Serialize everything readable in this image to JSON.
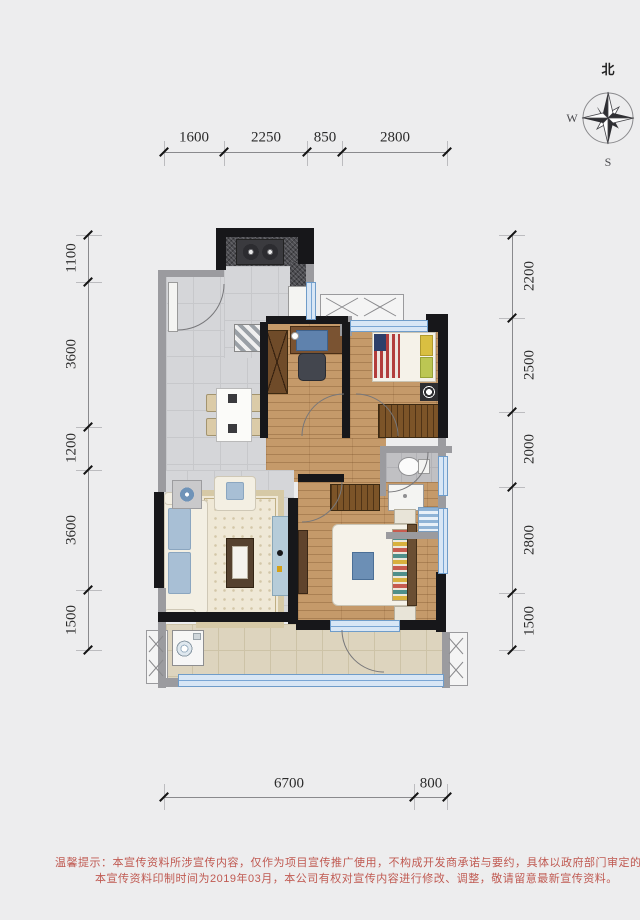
{
  "compass": {
    "north": "北",
    "west": "W",
    "east": "E",
    "south": "S"
  },
  "dimensions": {
    "top": [
      "1600",
      "2250",
      "850",
      "2800"
    ],
    "left": [
      "1100",
      "3600",
      "1200",
      "3600",
      "1500"
    ],
    "right": [
      "2200",
      "2500",
      "2000",
      "2800",
      "1500"
    ],
    "bottom": [
      "6700",
      "800"
    ]
  },
  "disclaimer": {
    "line1": "温馨提示：本宣传资料所涉宣传内容，仅作为项目宣传推广使用，不构成开发商承诺与要约，具体以政府部门审定的规划设计文件及商品房买卖合同约定",
    "line2": "本宣传资料印制时间为2019年03月，本公司有权对宣传内容进行修改、调整，敬请留意最新宣传资料。"
  },
  "palette": {
    "background": "#ededee",
    "wall_black": "#17171a",
    "wall_gray": "#9b9b9f",
    "window_blue": "#d8e6f5",
    "window_frame": "#6f9cc9",
    "wood_floor": "#c59a6a",
    "tile_gray": "#d5d6d9",
    "balcony_tile": "#ddd4be",
    "disclaimer_red": "#c05a52"
  }
}
